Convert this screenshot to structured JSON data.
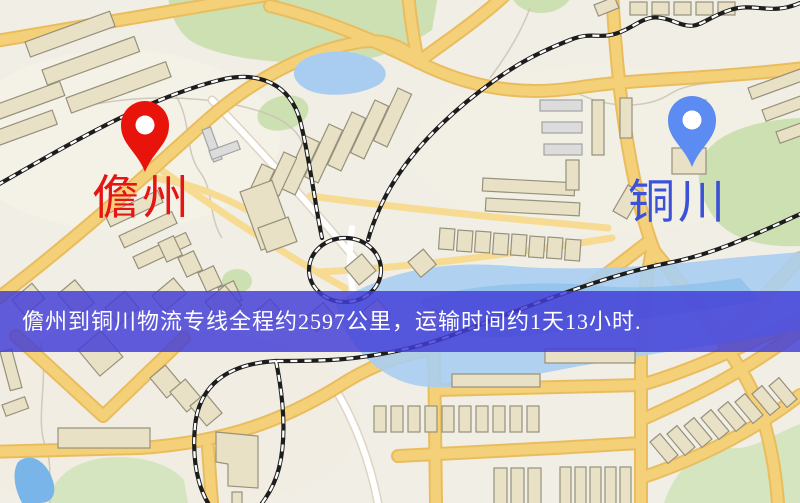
{
  "route_banner": {
    "text": "儋州到铜川物流专线全程约2597公里，运输时间约1天13小时.",
    "background_color": "#4340d4",
    "text_color": "#ffffff"
  },
  "markers": {
    "origin": {
      "label": "儋州",
      "pin_color": "#e8140c",
      "label_color": "#e41512"
    },
    "destination": {
      "label": "铜川",
      "pin_color": "#5c8cf2",
      "label_color": "#3b52d8"
    }
  },
  "map_palette": {
    "background": "#f1eee5",
    "road_major": "#f4d079",
    "road_casing": "#e9bd5e",
    "road_minor": "#f7db92",
    "road_white": "#ffffff",
    "water": "#a9cdf0",
    "park_green": "#cde0b2",
    "building_fill": "#e9e1c6",
    "building_grey": "#dcdcdc",
    "railway": "#1d1d1d"
  }
}
